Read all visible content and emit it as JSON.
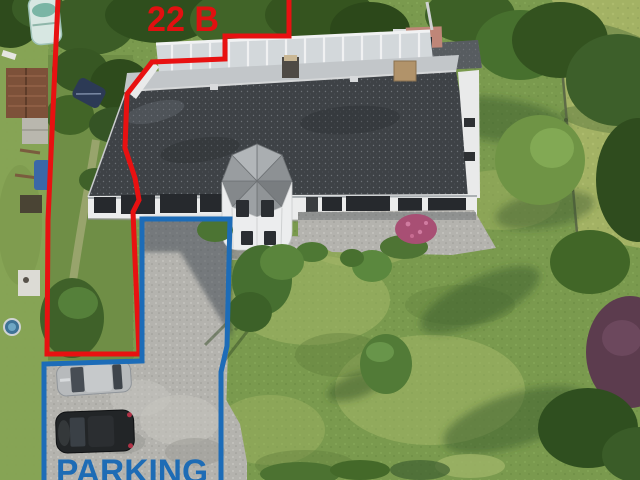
{
  "annotations": {
    "parcel_label": "22 B",
    "parcel_label_color": "#e11010",
    "parking_label": "PARKING",
    "parking_label_color": "#1e6cb5",
    "red_boundary_color": "#e81111",
    "blue_boundary_color": "#1c6cb8"
  },
  "scene": {
    "palette": {
      "lawn": "#7a9a4e",
      "sunlit_lawn": "#a3b264",
      "gravel": "#b4b3ae",
      "roof": "#3e4246",
      "house_wall": "#ebecec",
      "foliage_dark": "#33521f",
      "purple_tree": "#5c3c4e",
      "car_silver": "#b7babc",
      "car_black": "#222527"
    }
  }
}
